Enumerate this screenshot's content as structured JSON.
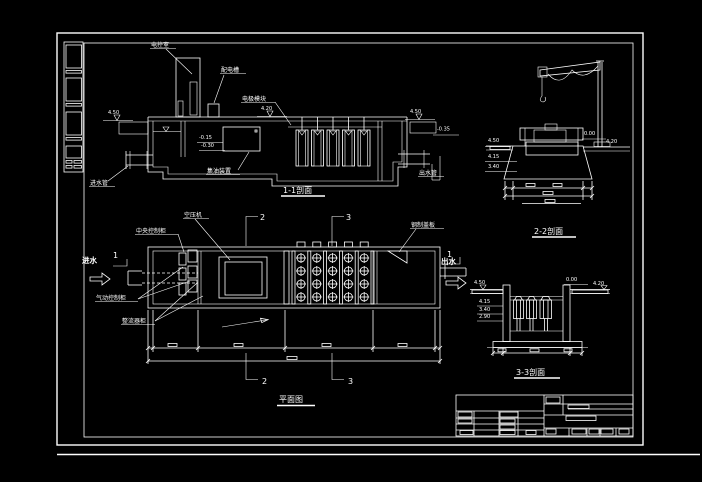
{
  "drawing": {
    "background": "#000000",
    "line_color": "#ffffff",
    "title_block_border_color": "#e81313",
    "title_block_grid_color": "#1e9fff",
    "sec11": {
      "title": "1-1剖面",
      "label_control_room": "电控室",
      "label_power_trough": "配电槽",
      "label_electrode_module": "电极模块",
      "label_oil_collector": "集油装置",
      "label_inlet_pipe": "进水管",
      "label_outlet_pipe": "出水管",
      "elev_ground_left": "4.50",
      "elev_deck": "4.20",
      "elev_ground_right": "4.50",
      "elev_pipe_invert": "-0.35",
      "elev_water_1": "-0.15",
      "elev_water_2": "-0.30"
    },
    "sec22": {
      "title": "2-2剖面",
      "elev_left_1": "4.50",
      "elev_left_2": "4.15",
      "elev_left_3": "3.40",
      "elev_right_1": "0.00",
      "elev_right_2": "4.20"
    },
    "plan": {
      "title": "平面图",
      "label_air_compressor": "空压机",
      "label_central_cabinet": "中央控制柜",
      "label_pneumatic_cabinet": "气动控制柜",
      "label_rectifier_cabinet": "整流器柜",
      "label_steel_cover": "钢制盖板",
      "flow_in": "进水",
      "flow_out": "出水",
      "mark_1": "1",
      "mark_2": "2",
      "mark_3": "3"
    },
    "sec33": {
      "title": "3-3剖面",
      "elev_ground_left": "4.50",
      "elev_wall_top": "0.00",
      "elev_ground_right": "4.20",
      "elev_left_1": "4.15",
      "elev_left_2": "3.40",
      "elev_left_3": "2.90"
    }
  }
}
